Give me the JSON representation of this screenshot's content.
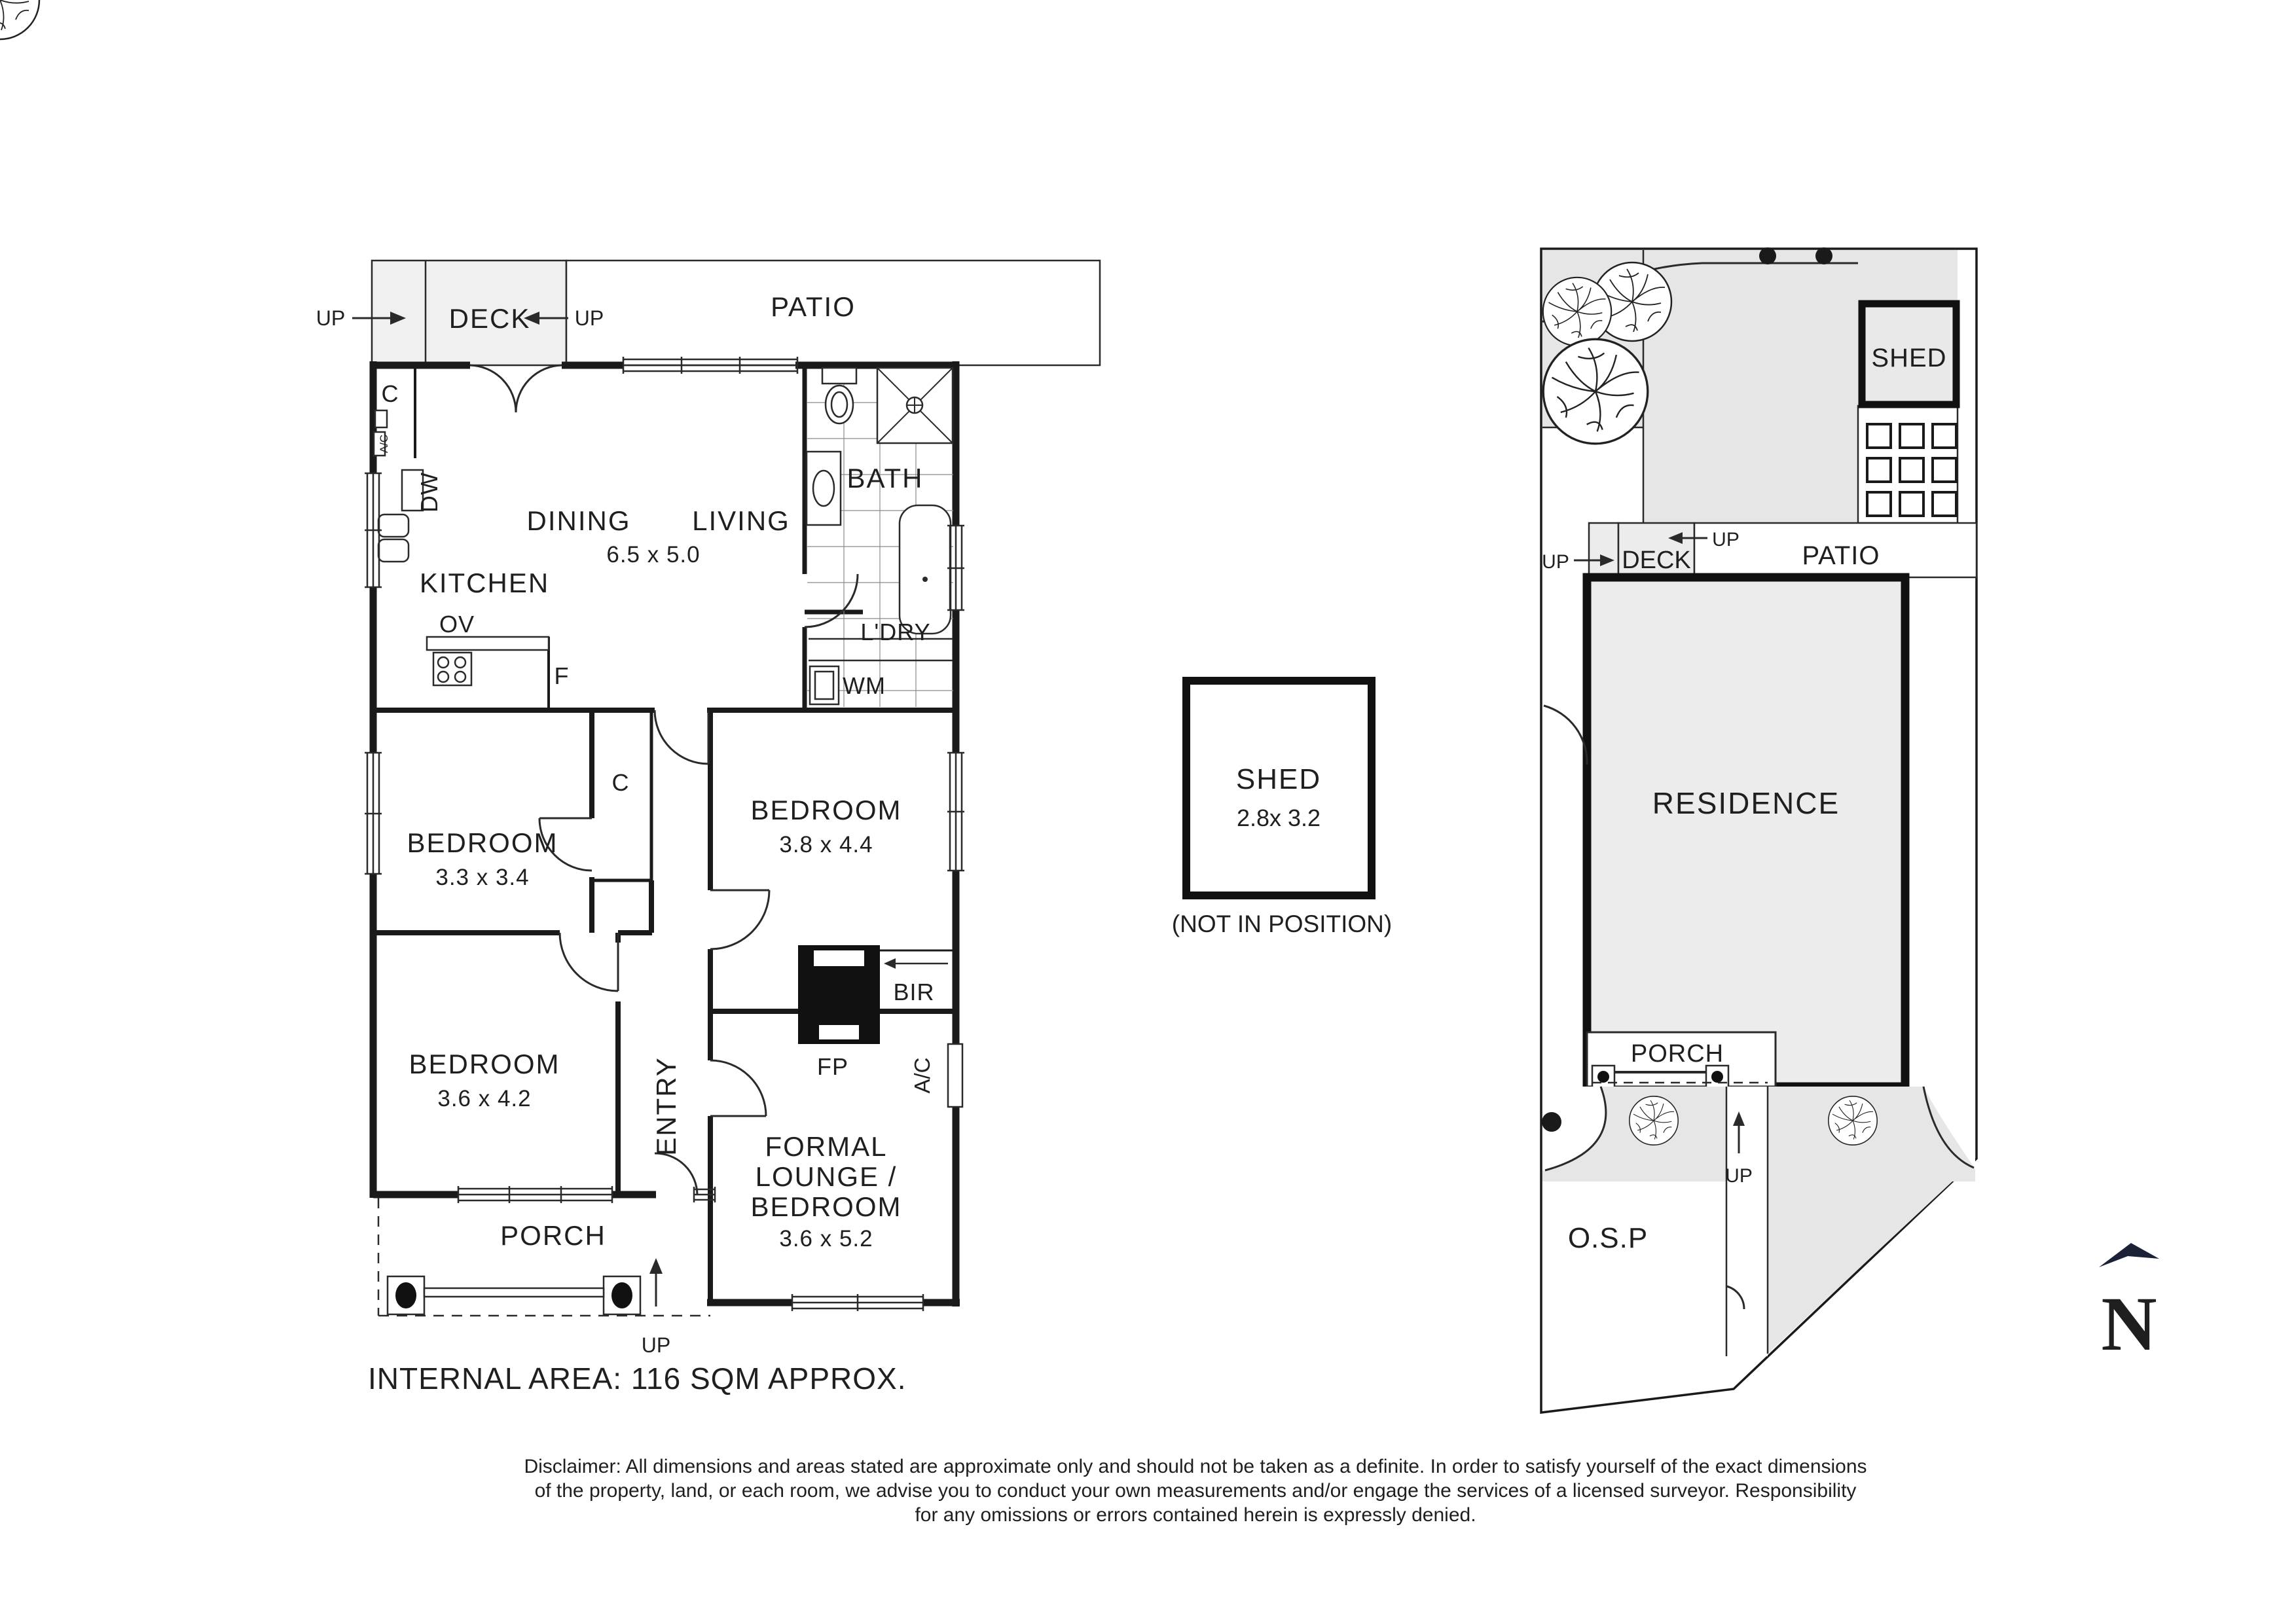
{
  "floorplan": {
    "deck": "DECK",
    "patio": "PATIO",
    "up": "UP",
    "dining": "DINING",
    "living": "LIVING",
    "living_dims": "6.5 x 5.0",
    "kitchen": "KITCHEN",
    "ov": "OV",
    "f": "F",
    "dw": "DW",
    "c_kitchen": "C",
    "ac_kitchen": "A/C",
    "bath": "BATH",
    "ldry": "L'DRY",
    "wm": "WM",
    "bed1": "BEDROOM",
    "bed1_dims": "3.3 x 3.4",
    "closet": "C",
    "bed2": "BEDROOM",
    "bed2_dims": "3.8 x 4.4",
    "bed3": "BEDROOM",
    "bed3_dims": "3.6 x 4.2",
    "entry": "ENTRY",
    "fp": "FP",
    "bir": "BIR",
    "ac_lounge": "A/C",
    "lounge_line1": "FORMAL",
    "lounge_line2": "LOUNGE /",
    "lounge_line3": "BEDROOM",
    "lounge_dims": "3.6 x 5.2",
    "porch": "PORCH",
    "internal_area": "INTERNAL AREA: 116 SQM APPROX."
  },
  "shed_detail": {
    "label": "SHED",
    "dims": "2.8x 3.2",
    "note": "(NOT IN POSITION)"
  },
  "siteplan": {
    "shed": "SHED",
    "deck": "DECK",
    "patio": "PATIO",
    "residence": "RESIDENCE",
    "porch": "PORCH",
    "osp": "O.S.P",
    "up": "UP",
    "north": "N"
  },
  "disclaimer": {
    "line1": "Disclaimer: All dimensions and areas stated are approximate only and should not be taken as a definite. In order to satisfy yourself of the exact dimensions",
    "line2": "of the property, land, or each room, we advise you to conduct your own measurements and/or engage the services of a licensed surveyor. Responsibility",
    "line3": "for any omissions or errors contained herein is expressly denied."
  },
  "colors": {
    "wall": "#1a1a1a",
    "deck_fill": "#f0f0f0",
    "yard_fill": "#e6e6e6",
    "residence_fill": "#ececec",
    "north_navy": "#1b2136"
  }
}
